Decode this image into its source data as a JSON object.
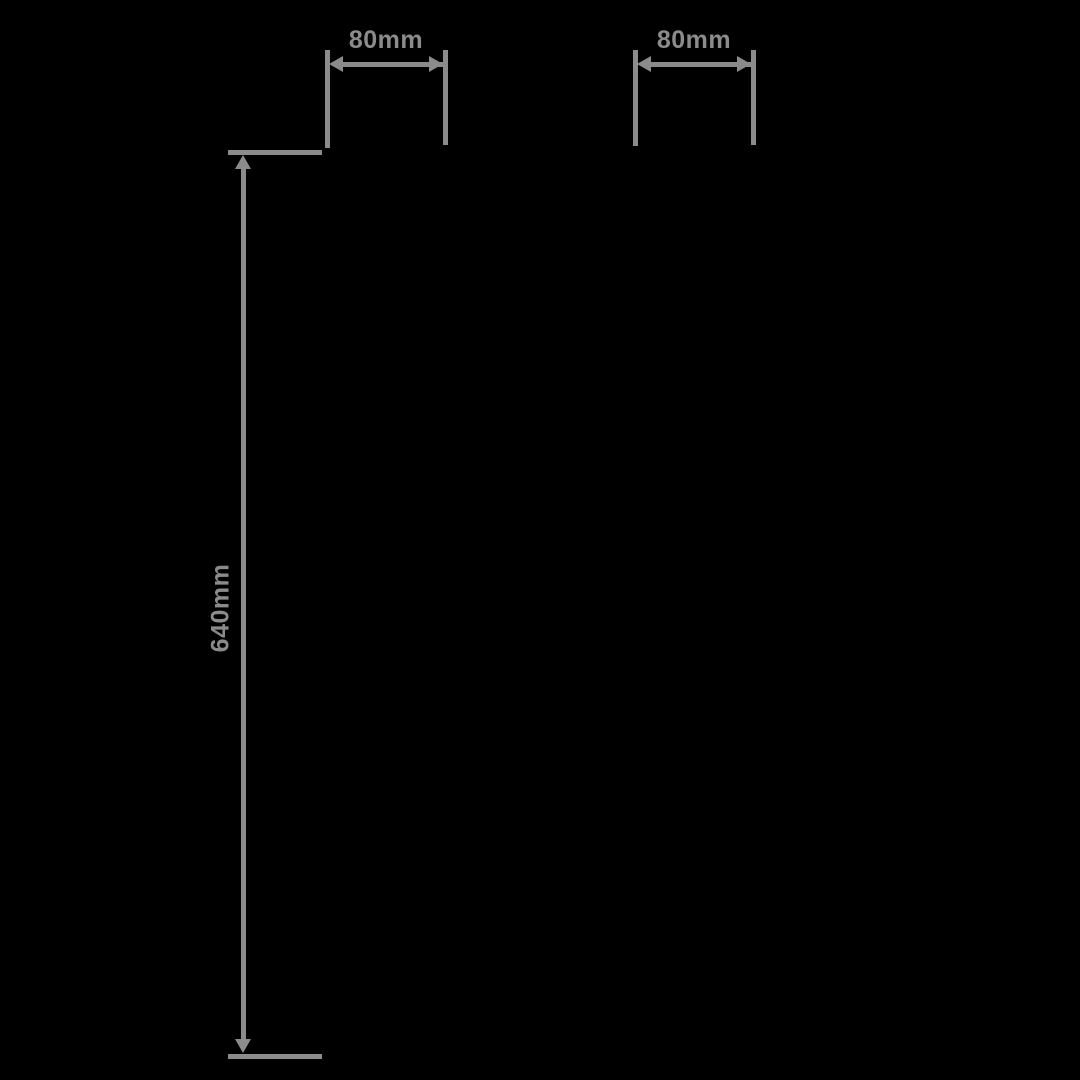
{
  "diagram": {
    "type": "product-dimension-diagram",
    "background_color": "#000000",
    "line_color": "#8b8b8b",
    "dimensions": {
      "top_left_width": {
        "label": "80mm",
        "orientation": "horizontal"
      },
      "top_right_width": {
        "label": "80mm",
        "orientation": "horizontal"
      },
      "left_height": {
        "label": "640mm",
        "orientation": "vertical"
      }
    }
  }
}
